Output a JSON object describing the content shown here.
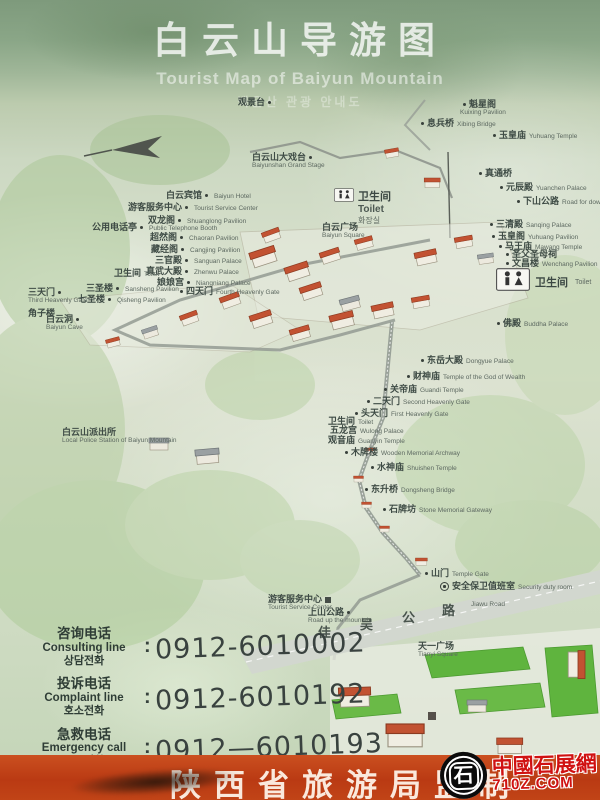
{
  "title": {
    "zh": "白云山导游图",
    "en": "Tourist Map of Baiyun Mountain",
    "ko": "백운산 관광 안내도"
  },
  "map": {
    "toilet_center": {
      "zh": "卫生间",
      "en": "Toilet",
      "ko": "화장실"
    },
    "toilet_right": {
      "zh": "卫生间",
      "en": "Toilet"
    },
    "labels": [
      {
        "zh": "观景台",
        "en": "",
        "x": 238,
        "y": 97,
        "dot": "r"
      },
      {
        "zh": "魁星阁",
        "en": "Kuixing Pavilion",
        "x": 460,
        "y": 99,
        "dot": "l",
        "stack": true
      },
      {
        "zh": "息兵桥",
        "en": "Xibing Bridge",
        "x": 418,
        "y": 118,
        "dot": "l"
      },
      {
        "zh": "玉皇庙",
        "en": "Yuhuang Temple",
        "x": 490,
        "y": 130,
        "dot": "l"
      },
      {
        "zh": "白云山大戏台",
        "en": "Baiyunshan Grand Stage",
        "x": 252,
        "y": 152,
        "dot": "r",
        "stack": true
      },
      {
        "zh": "真通桥",
        "en": "",
        "x": 476,
        "y": 168,
        "dot": "l"
      },
      {
        "zh": "元辰殿",
        "en": "Yuanchen Palace",
        "x": 497,
        "y": 182,
        "dot": "l"
      },
      {
        "zh": "下山公路",
        "en": "Road for downhill",
        "x": 514,
        "y": 196,
        "dot": "l"
      },
      {
        "zh": "白云宾馆",
        "en": "Baiyun Hotel",
        "x": 166,
        "y": 190,
        "dot": "r"
      },
      {
        "zh": "游客服务中心",
        "en": "Tourist Service Center",
        "x": 128,
        "y": 202,
        "dot": "r"
      },
      {
        "zh": "双龙阁",
        "en": "Shuanglong Pavilion",
        "x": 148,
        "y": 215,
        "dot": "r"
      },
      {
        "zh": "公用电话亭",
        "en": "Public Telephone Booth",
        "x": 92,
        "y": 222,
        "dot": "r"
      },
      {
        "zh": "超然阁",
        "en": "Chaoran Pavilion",
        "x": 150,
        "y": 232,
        "dot": "r"
      },
      {
        "zh": "藏经阁",
        "en": "Cangjing Pavilion",
        "x": 151,
        "y": 244,
        "dot": "r"
      },
      {
        "zh": "三官殿",
        "en": "Sanguan Palace",
        "x": 155,
        "y": 255,
        "dot": "r"
      },
      {
        "zh": "真武大殿",
        "en": "Zhenwu Palace",
        "x": 146,
        "y": 266,
        "dot": "r"
      },
      {
        "zh": "卫生间",
        "en": "Toilet",
        "x": 114,
        "y": 268,
        "dot": "n"
      },
      {
        "zh": "娘娘宫",
        "en": "Niangniang Palace",
        "x": 157,
        "y": 277,
        "dot": "r"
      },
      {
        "zh": "三圣楼",
        "en": "Sansheng Pavilion",
        "x": 86,
        "y": 283,
        "dot": "r"
      },
      {
        "zh": "四天门",
        "en": "Fourth Heavenly Gate",
        "x": 177,
        "y": 286,
        "dot": "l"
      },
      {
        "zh": "七圣楼",
        "en": "Qisheng Pavilion",
        "x": 78,
        "y": 294,
        "dot": "r"
      },
      {
        "zh": "三天门",
        "en": "Third Heavenly Gate",
        "x": 28,
        "y": 287,
        "dot": "r",
        "stack": true
      },
      {
        "zh": "角子楼",
        "en": "",
        "x": 28,
        "y": 308,
        "dot": "n"
      },
      {
        "zh": "白云洞",
        "en": "Baiyun Cave",
        "x": 46,
        "y": 314,
        "dot": "r",
        "stack": true
      },
      {
        "zh": "白云广场",
        "en": "Baiyun Square",
        "x": 322,
        "y": 222,
        "dot": "n",
        "stack": true
      },
      {
        "zh": "三清殿",
        "en": "Sanqing Palace",
        "x": 487,
        "y": 219,
        "dot": "l"
      },
      {
        "zh": "玉皇阁",
        "en": "Yuhuang Pavilion",
        "x": 489,
        "y": 231,
        "dot": "l"
      },
      {
        "zh": "马王庙",
        "en": "Mawang Temple",
        "x": 496,
        "y": 241,
        "dot": "l"
      },
      {
        "zh": "圣父圣母祠",
        "en": "",
        "x": 503,
        "y": 249,
        "dot": "l"
      },
      {
        "zh": "文昌楼",
        "en": "Wenchang Pavilion",
        "x": 503,
        "y": 258,
        "dot": "l"
      },
      {
        "zh": "佛殿",
        "en": "Buddha Palace",
        "x": 494,
        "y": 318,
        "dot": "l"
      },
      {
        "zh": "东岳大殿",
        "en": "Dongyue Palace",
        "x": 418,
        "y": 355,
        "dot": "l"
      },
      {
        "zh": "财神庙",
        "en": "Temple of the God of Wealth",
        "x": 404,
        "y": 371,
        "dot": "l"
      },
      {
        "zh": "关帝庙",
        "en": "Guandi Temple",
        "x": 381,
        "y": 384,
        "dot": "l"
      },
      {
        "zh": "二天门",
        "en": "Second Heavenly Gate",
        "x": 364,
        "y": 396,
        "dot": "l"
      },
      {
        "zh": "头天门",
        "en": "First Heavenly Gate",
        "x": 352,
        "y": 408,
        "dot": "l"
      },
      {
        "zh": "卫生间",
        "en": "Toilet",
        "x": 328,
        "y": 416,
        "dot": "n"
      },
      {
        "zh": "五龙宫",
        "en": "Wulong Palace",
        "x": 330,
        "y": 425,
        "dot": "n"
      },
      {
        "zh": "观音庙",
        "en": "Guanyin Temple",
        "x": 328,
        "y": 435,
        "dot": "n"
      },
      {
        "zh": "木牌楼",
        "en": "Wooden Memorial Archway",
        "x": 342,
        "y": 447,
        "dot": "l"
      },
      {
        "zh": "水神庙",
        "en": "Shuishen Temple",
        "x": 368,
        "y": 462,
        "dot": "l"
      },
      {
        "zh": "东升桥",
        "en": "Dongsheng Bridge",
        "x": 362,
        "y": 484,
        "dot": "l"
      },
      {
        "zh": "石牌坊",
        "en": "Stone Memorial Gateway",
        "x": 380,
        "y": 504,
        "dot": "l"
      },
      {
        "zh": "山门",
        "en": "Temple Gate",
        "x": 422,
        "y": 568,
        "dot": "l"
      },
      {
        "zh": "安全保卫值班室",
        "en": "Security duty room",
        "x": 440,
        "y": 581,
        "dot": "n",
        "icon": "badge"
      },
      {
        "zh": "白云山派出所",
        "en": "Local Police Station of Baiyun Mountain",
        "x": 62,
        "y": 427,
        "dot": "n",
        "stack": true
      },
      {
        "zh": "游客服务中心",
        "en": "Tourist Service Center",
        "x": 268,
        "y": 594,
        "dot": "n",
        "icon": "sq",
        "stack": true
      },
      {
        "zh": "上山公路",
        "en": "Road up the mountain",
        "x": 308,
        "y": 607,
        "dot": "r",
        "stack": true
      },
      {
        "zh": "",
        "en": "Jiawu Road",
        "x": 468,
        "y": 598,
        "dot": "n"
      },
      {
        "zh": "天一广场",
        "en": "Tianyi Square",
        "x": 418,
        "y": 641,
        "dot": "n",
        "stack": true
      }
    ],
    "road_chars": [
      {
        "c": "佳",
        "x": 318,
        "y": 622
      },
      {
        "c": "吴",
        "x": 360,
        "y": 614
      },
      {
        "c": "公",
        "x": 402,
        "y": 607
      },
      {
        "c": "路",
        "x": 442,
        "y": 600
      }
    ]
  },
  "contact": {
    "rows": [
      {
        "zh": "咨询电话",
        "en": "Consulting line",
        "ko": "상담전화",
        "colon": ":",
        "number": "0912-6010002"
      },
      {
        "zh": "投诉电话",
        "en": "Complaint line",
        "ko": "호소전화",
        "colon": ":",
        "number": "0912-6010192"
      },
      {
        "zh": "急救电话",
        "en": "Emergency call",
        "ko": "구급전화",
        "colon": ":",
        "number": "0912—6010193"
      }
    ]
  },
  "footer": {
    "text": "陕西省旅游局监制"
  },
  "watermark": {
    "glyph": "石",
    "site_zh": "中國石展網",
    "site_url": "710Z.COM"
  },
  "colors": {
    "banner": "#ba3a13",
    "roof_red": "#c25232",
    "lawn_green": "#5fb43e",
    "watermark_red": "#d01111"
  }
}
